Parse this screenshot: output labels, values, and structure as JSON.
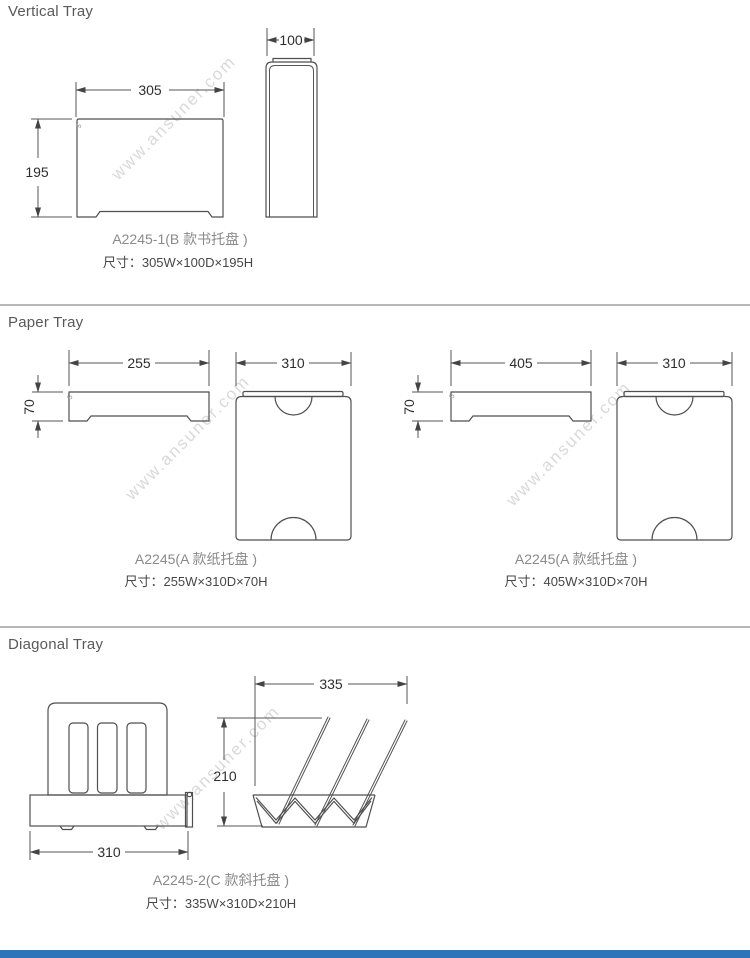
{
  "page": {
    "background": "#ffffff",
    "line_color": "#4f4f4f",
    "divider_color": "#6f6f6f",
    "footer_bar_color": "#2e74b8"
  },
  "watermark": {
    "text": "www.ansuner.com",
    "color": "#d9d9d9"
  },
  "sections": {
    "vertical": {
      "title": "Vertical Tray",
      "front_width": "305",
      "front_height": "195",
      "corner_note": "5",
      "side_depth": "100",
      "model_label": "A2245-1(B 款书托盘 )",
      "size_label": "尺寸：305W×100D×195H"
    },
    "paper": {
      "title": "Paper Tray",
      "small": {
        "front_width": "255",
        "front_height": "70",
        "corner_note": "5",
        "top_depth": "310",
        "model_label": "A2245(A 款纸托盘 )",
        "size_label": "尺寸：255W×310D×70H"
      },
      "large": {
        "front_width": "405",
        "front_height": "70",
        "corner_note": "5",
        "top_depth": "310",
        "model_label": "A2245(A 款纸托盘 )",
        "size_label": "尺寸：405W×310D×70H"
      }
    },
    "diagonal": {
      "title": "Diagonal Tray",
      "front_width": "310",
      "side_width": "335",
      "side_height": "210",
      "model_label": "A2245-2(C 款斜托盘 )",
      "size_label": "尺寸：335W×310D×210H"
    }
  }
}
